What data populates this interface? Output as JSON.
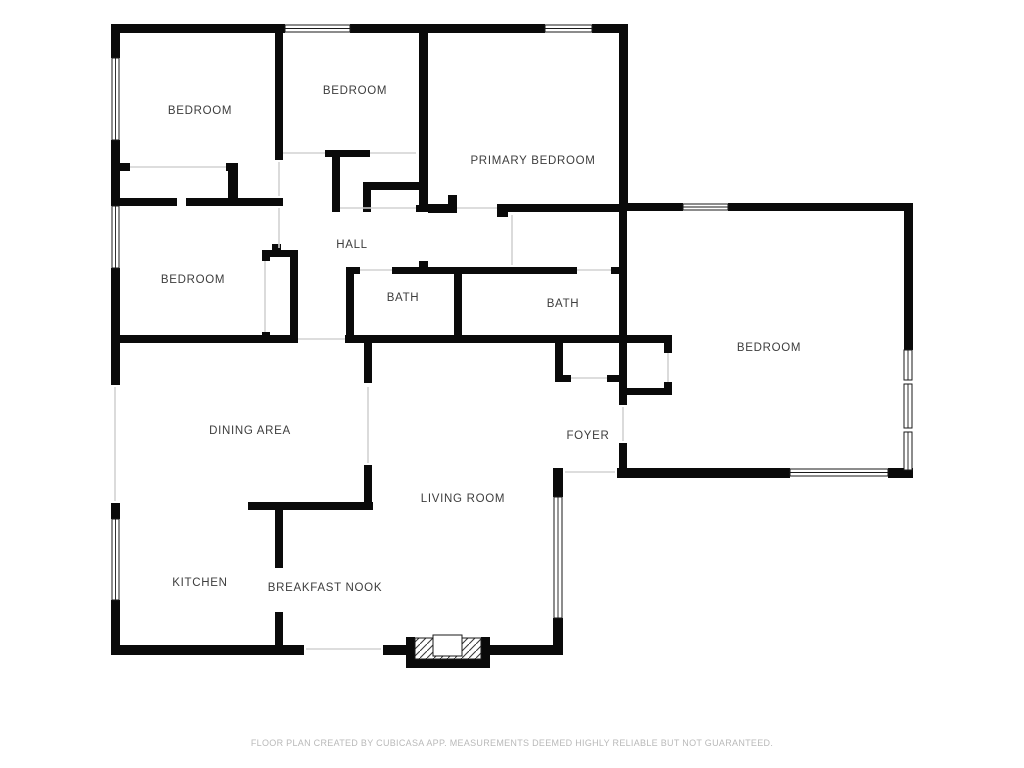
{
  "title": "Floor plan",
  "footer": {
    "disclaimer": "FLOOR PLAN CREATED BY CUBICASA APP. MEASUREMENTS DEEMED HIGHLY RELIABLE BUT NOT GUARANTEED."
  },
  "colors": {
    "background": "#ffffff",
    "wall": "#0a0a0a",
    "label": "#3d3d3d",
    "footer_text": "#b9b9b9",
    "opening_line": "#d2d2d2",
    "window_stroke": "#1a1a1a"
  },
  "rooms": [
    {
      "name": "bedroom-1",
      "label": "BEDROOM",
      "x": 200,
      "y": 114
    },
    {
      "name": "bedroom-2",
      "label": "BEDROOM",
      "x": 355,
      "y": 94
    },
    {
      "name": "primary-bedroom",
      "label": "PRIMARY BEDROOM",
      "x": 533,
      "y": 164
    },
    {
      "name": "bedroom-3",
      "label": "BEDROOM",
      "x": 193,
      "y": 283
    },
    {
      "name": "hall",
      "label": "HALL",
      "x": 352,
      "y": 248
    },
    {
      "name": "bath-1",
      "label": "BATH",
      "x": 403,
      "y": 301
    },
    {
      "name": "bath-2",
      "label": "BATH",
      "x": 563,
      "y": 307
    },
    {
      "name": "bedroom-4",
      "label": "BEDROOM",
      "x": 769,
      "y": 351
    },
    {
      "name": "dining-area",
      "label": "DINING AREA",
      "x": 250,
      "y": 434
    },
    {
      "name": "foyer",
      "label": "FOYER",
      "x": 588,
      "y": 439
    },
    {
      "name": "living-room",
      "label": "LIVING ROOM",
      "x": 463,
      "y": 502
    },
    {
      "name": "kitchen",
      "label": "KITCHEN",
      "x": 200,
      "y": 586
    },
    {
      "name": "breakfast-nook",
      "label": "BREAKFAST NOOK",
      "x": 325,
      "y": 591
    }
  ],
  "walls": [
    [
      112,
      24,
      173,
      9
    ],
    [
      350,
      24,
      195,
      9
    ],
    [
      592,
      24,
      36,
      9
    ],
    [
      111,
      24,
      9,
      34
    ],
    [
      111,
      140,
      9,
      66
    ],
    [
      111,
      268,
      9,
      117
    ],
    [
      111,
      503,
      9,
      16
    ],
    [
      111,
      600,
      9,
      55
    ],
    [
      111,
      645,
      193,
      10
    ],
    [
      383,
      645,
      27,
      10
    ],
    [
      488,
      645,
      75,
      10
    ],
    [
      275,
      24,
      8,
      136
    ],
    [
      111,
      163,
      19,
      8
    ],
    [
      226,
      163,
      12,
      8
    ],
    [
      228,
      163,
      10,
      43
    ],
    [
      111,
      198,
      66,
      8
    ],
    [
      186,
      198,
      97,
      8
    ],
    [
      262,
      250,
      36,
      7
    ],
    [
      272,
      244,
      9,
      6
    ],
    [
      290,
      250,
      8,
      93
    ],
    [
      262,
      250,
      8,
      11
    ],
    [
      262,
      332,
      8,
      11
    ],
    [
      111,
      335,
      187,
      8
    ],
    [
      325,
      150,
      45,
      7
    ],
    [
      332,
      150,
      8,
      62
    ],
    [
      363,
      182,
      59,
      8
    ],
    [
      363,
      190,
      8,
      22
    ],
    [
      419,
      24,
      9,
      188
    ],
    [
      332,
      205,
      8,
      7
    ],
    [
      363,
      205,
      8,
      7
    ],
    [
      416,
      205,
      12,
      7
    ],
    [
      448,
      195,
      9,
      18
    ],
    [
      428,
      204,
      29,
      9
    ],
    [
      497,
      204,
      130,
      8
    ],
    [
      497,
      204,
      11,
      13
    ],
    [
      346,
      267,
      8,
      76
    ],
    [
      346,
      267,
      14,
      7
    ],
    [
      392,
      267,
      70,
      7
    ],
    [
      419,
      261,
      9,
      7
    ],
    [
      454,
      267,
      8,
      76
    ],
    [
      454,
      267,
      123,
      7
    ],
    [
      611,
      267,
      9,
      7
    ],
    [
      345,
      335,
      327,
      8
    ],
    [
      364,
      343,
      8,
      40
    ],
    [
      364,
      465,
      8,
      40
    ],
    [
      248,
      502,
      125,
      8
    ],
    [
      275,
      502,
      8,
      66
    ],
    [
      275,
      612,
      8,
      36
    ],
    [
      619,
      24,
      9,
      179
    ],
    [
      619,
      203,
      8,
      202
    ],
    [
      619,
      443,
      8,
      34
    ],
    [
      620,
      203,
      63,
      8
    ],
    [
      728,
      203,
      185,
      8
    ],
    [
      904,
      203,
      9,
      147
    ],
    [
      904,
      468,
      9,
      10
    ],
    [
      617,
      468,
      173,
      10
    ],
    [
      888,
      468,
      25,
      10
    ],
    [
      555,
      343,
      8,
      39
    ],
    [
      555,
      375,
      16,
      7
    ],
    [
      607,
      375,
      12,
      7
    ],
    [
      627,
      388,
      45,
      7
    ],
    [
      664,
      343,
      8,
      10
    ],
    [
      664,
      382,
      8,
      13
    ],
    [
      553,
      468,
      10,
      29
    ],
    [
      553,
      618,
      10,
      37
    ],
    [
      406,
      637,
      9,
      31
    ],
    [
      481,
      637,
      9,
      31
    ],
    [
      406,
      659,
      84,
      9
    ]
  ],
  "windows": [
    {
      "x": 285,
      "y": 25,
      "w": 65,
      "h": 7,
      "o": "h"
    },
    {
      "x": 545,
      "y": 25,
      "w": 47,
      "h": 7,
      "o": "h"
    },
    {
      "x": 112,
      "y": 58,
      "w": 7,
      "h": 82,
      "o": "v"
    },
    {
      "x": 112,
      "y": 206,
      "w": 7,
      "h": 62,
      "o": "v"
    },
    {
      "x": 112,
      "y": 519,
      "w": 7,
      "h": 81,
      "o": "v"
    },
    {
      "x": 683,
      "y": 204,
      "w": 45,
      "h": 6,
      "o": "h"
    },
    {
      "x": 904,
      "y": 350,
      "w": 8,
      "h": 30,
      "o": "v"
    },
    {
      "x": 904,
      "y": 384,
      "w": 8,
      "h": 44,
      "o": "v"
    },
    {
      "x": 904,
      "y": 432,
      "w": 8,
      "h": 38,
      "o": "v"
    },
    {
      "x": 790,
      "y": 469,
      "w": 98,
      "h": 7,
      "o": "h"
    },
    {
      "x": 554,
      "y": 497,
      "w": 8,
      "h": 121,
      "o": "v"
    }
  ],
  "openings": [
    [
      130,
      167,
      226,
      167
    ],
    [
      283,
      153,
      325,
      153
    ],
    [
      370,
      153,
      416,
      153
    ],
    [
      340,
      208,
      416,
      208
    ],
    [
      457,
      208,
      497,
      208
    ],
    [
      360,
      270,
      392,
      270
    ],
    [
      577,
      270,
      611,
      270
    ],
    [
      265,
      261,
      265,
      332
    ],
    [
      298,
      339,
      345,
      339
    ],
    [
      368,
      387,
      368,
      463
    ],
    [
      115,
      387,
      115,
      501
    ],
    [
      306,
      649,
      381,
      649
    ],
    [
      623,
      407,
      623,
      441
    ],
    [
      565,
      472,
      615,
      472
    ],
    [
      571,
      378,
      607,
      378
    ],
    [
      668,
      353,
      668,
      382
    ],
    [
      279,
      162,
      279,
      196
    ],
    [
      279,
      208,
      279,
      248
    ],
    [
      512,
      215,
      512,
      265
    ]
  ],
  "entry": {
    "hatch": [
      415,
      638,
      66,
      21
    ],
    "box": [
      433,
      635,
      29,
      21
    ]
  },
  "footer_pos": {
    "x": 512,
    "y": 746
  }
}
